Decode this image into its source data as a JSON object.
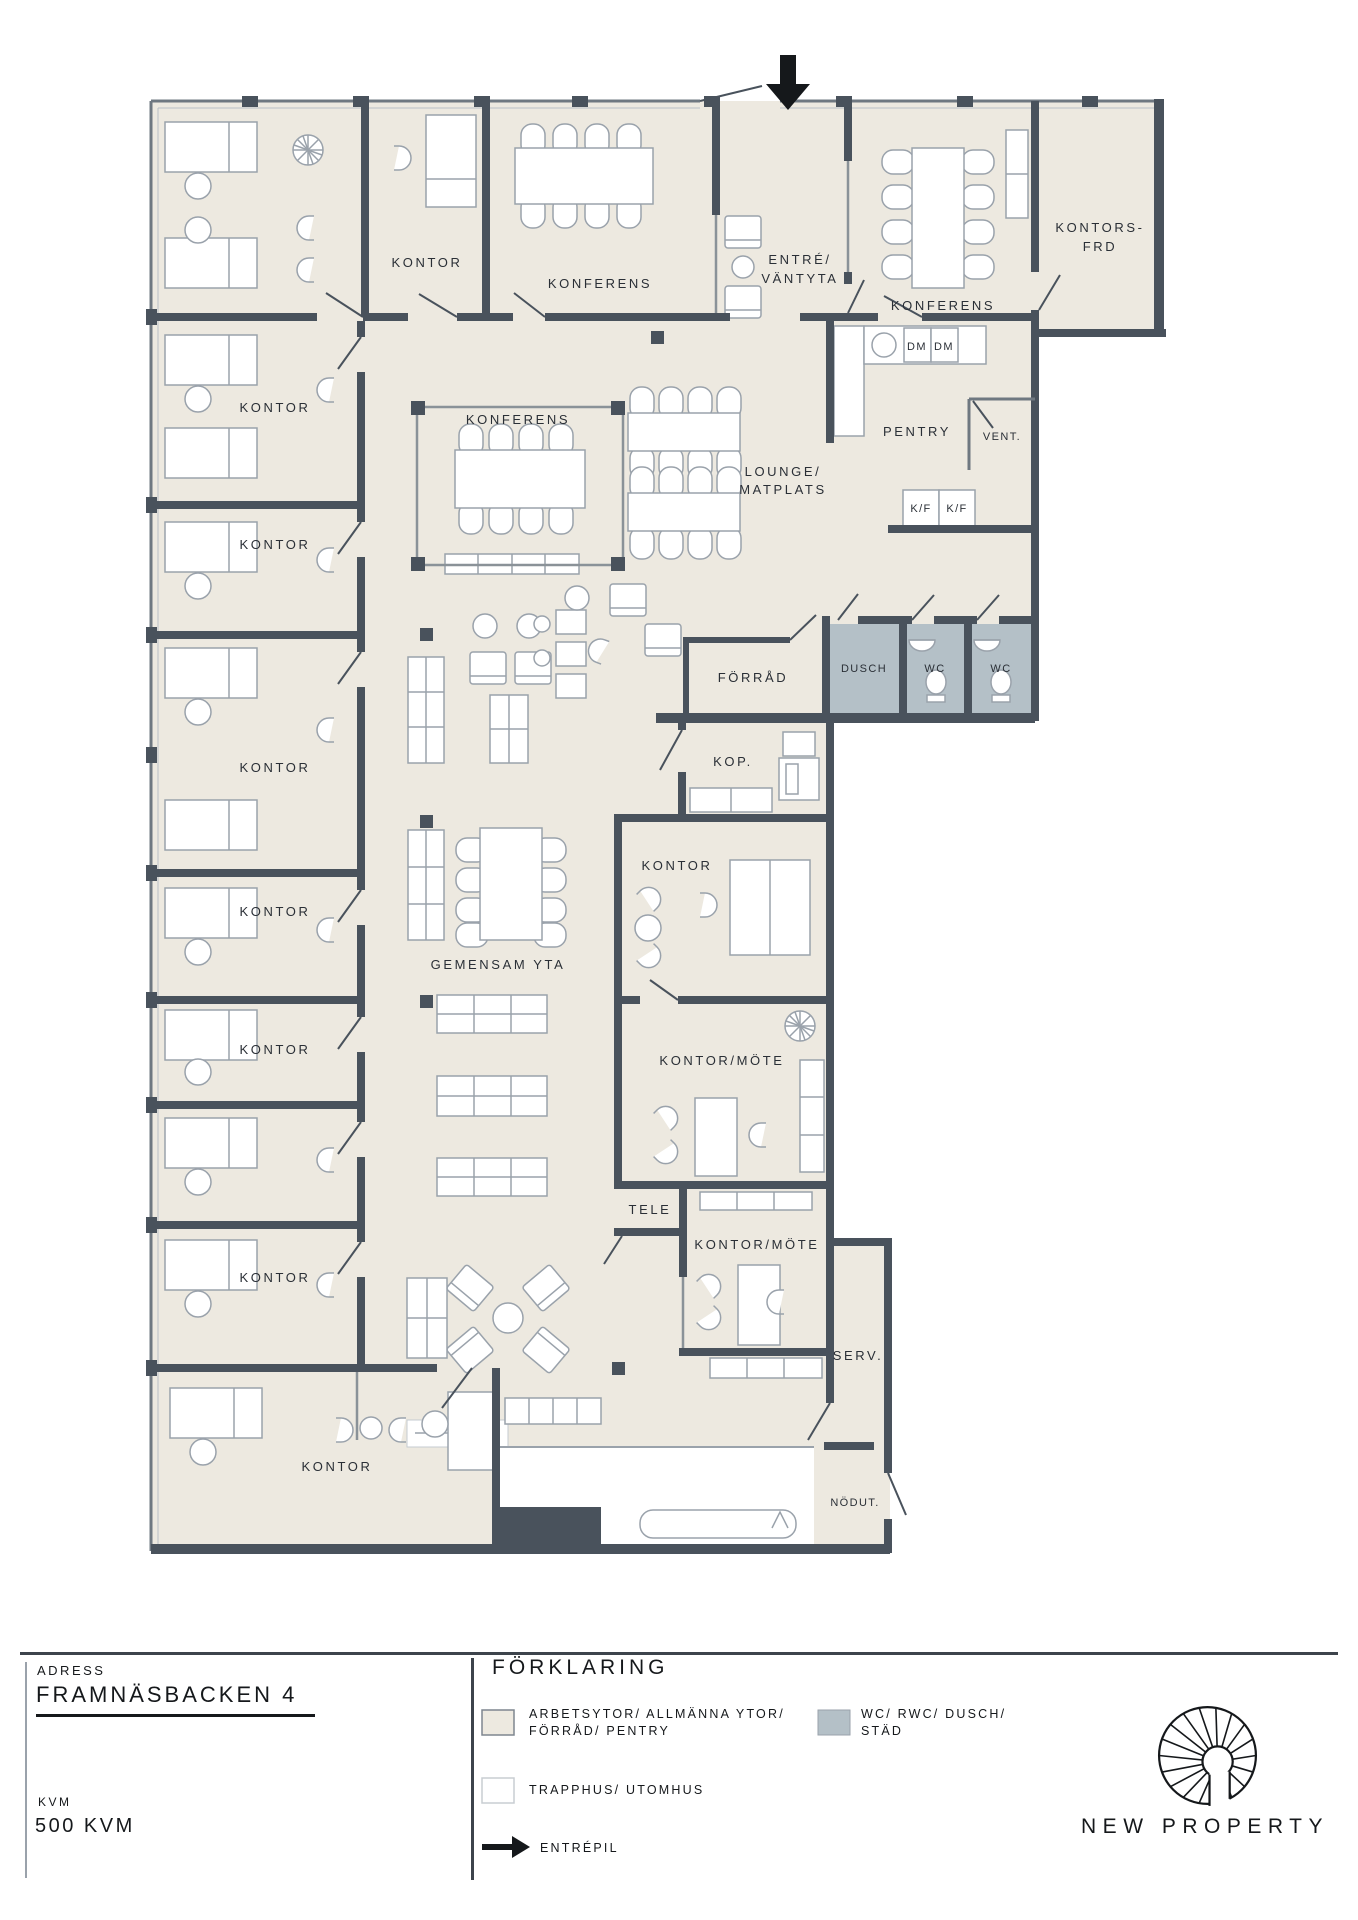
{
  "colors": {
    "floor": "#EDE9E0",
    "wet": "#B4C0C7",
    "wall": "#49525C",
    "furniture_outline": "#9AA2AB",
    "glass": "#8A9298",
    "text": "#2A2F36",
    "ink": "#15181B"
  },
  "icons": {
    "entrance_arrow": "down-arrow",
    "legend_arrow": "right-arrow",
    "logo": "spiral-staircase"
  },
  "plan": {
    "labels": {
      "kontor": "KONTOR",
      "konferens": "KONFERENS",
      "entre_line1": "ENTRÉ/",
      "entre_line2": "VÄNTYTA",
      "kontorsfrd_line1": "KONTORS-",
      "kontorsfrd_line2": "FRD",
      "pentry": "PENTRY",
      "vent": "VENT.",
      "lounge_line1": "LOUNGE/",
      "lounge_line2": "MATPLATS",
      "dm": "DM",
      "kf": "K/F",
      "dusch": "DUSCH",
      "wc": "WC",
      "forrad": "FÖRRÅD",
      "kop": "KOP.",
      "gemensam": "GEMENSAM YTA",
      "kontor_mote": "KONTOR/MÖTE",
      "tele": "TELE",
      "serv": "SERV.",
      "nodut": "NÖDUT."
    }
  },
  "footer": {
    "address_label": "ADRESS",
    "address": "FRAMNÄSBACKEN 4",
    "kvm_label": "KVM",
    "kvm_value": "500 KVM",
    "legend_title": "FÖRKLARING",
    "legend": [
      {
        "line1": "ARBETSYTOR/ ALLMÄNNA YTOR/",
        "line2": "FÖRRÅD/ PENTRY",
        "swatch": "#EDE9E0"
      },
      {
        "line1": "WC/ RWC/ DUSCH/",
        "line2": "STÄD",
        "swatch": "#B4C0C7"
      },
      {
        "line1": "TRAPPHUS/ UTOMHUS",
        "line2": "",
        "swatch": "#FFFFFF"
      },
      {
        "line1": "ENTRÉPIL",
        "line2": "",
        "swatch": "arrow"
      }
    ],
    "brand": "NEW PROPERTY"
  }
}
